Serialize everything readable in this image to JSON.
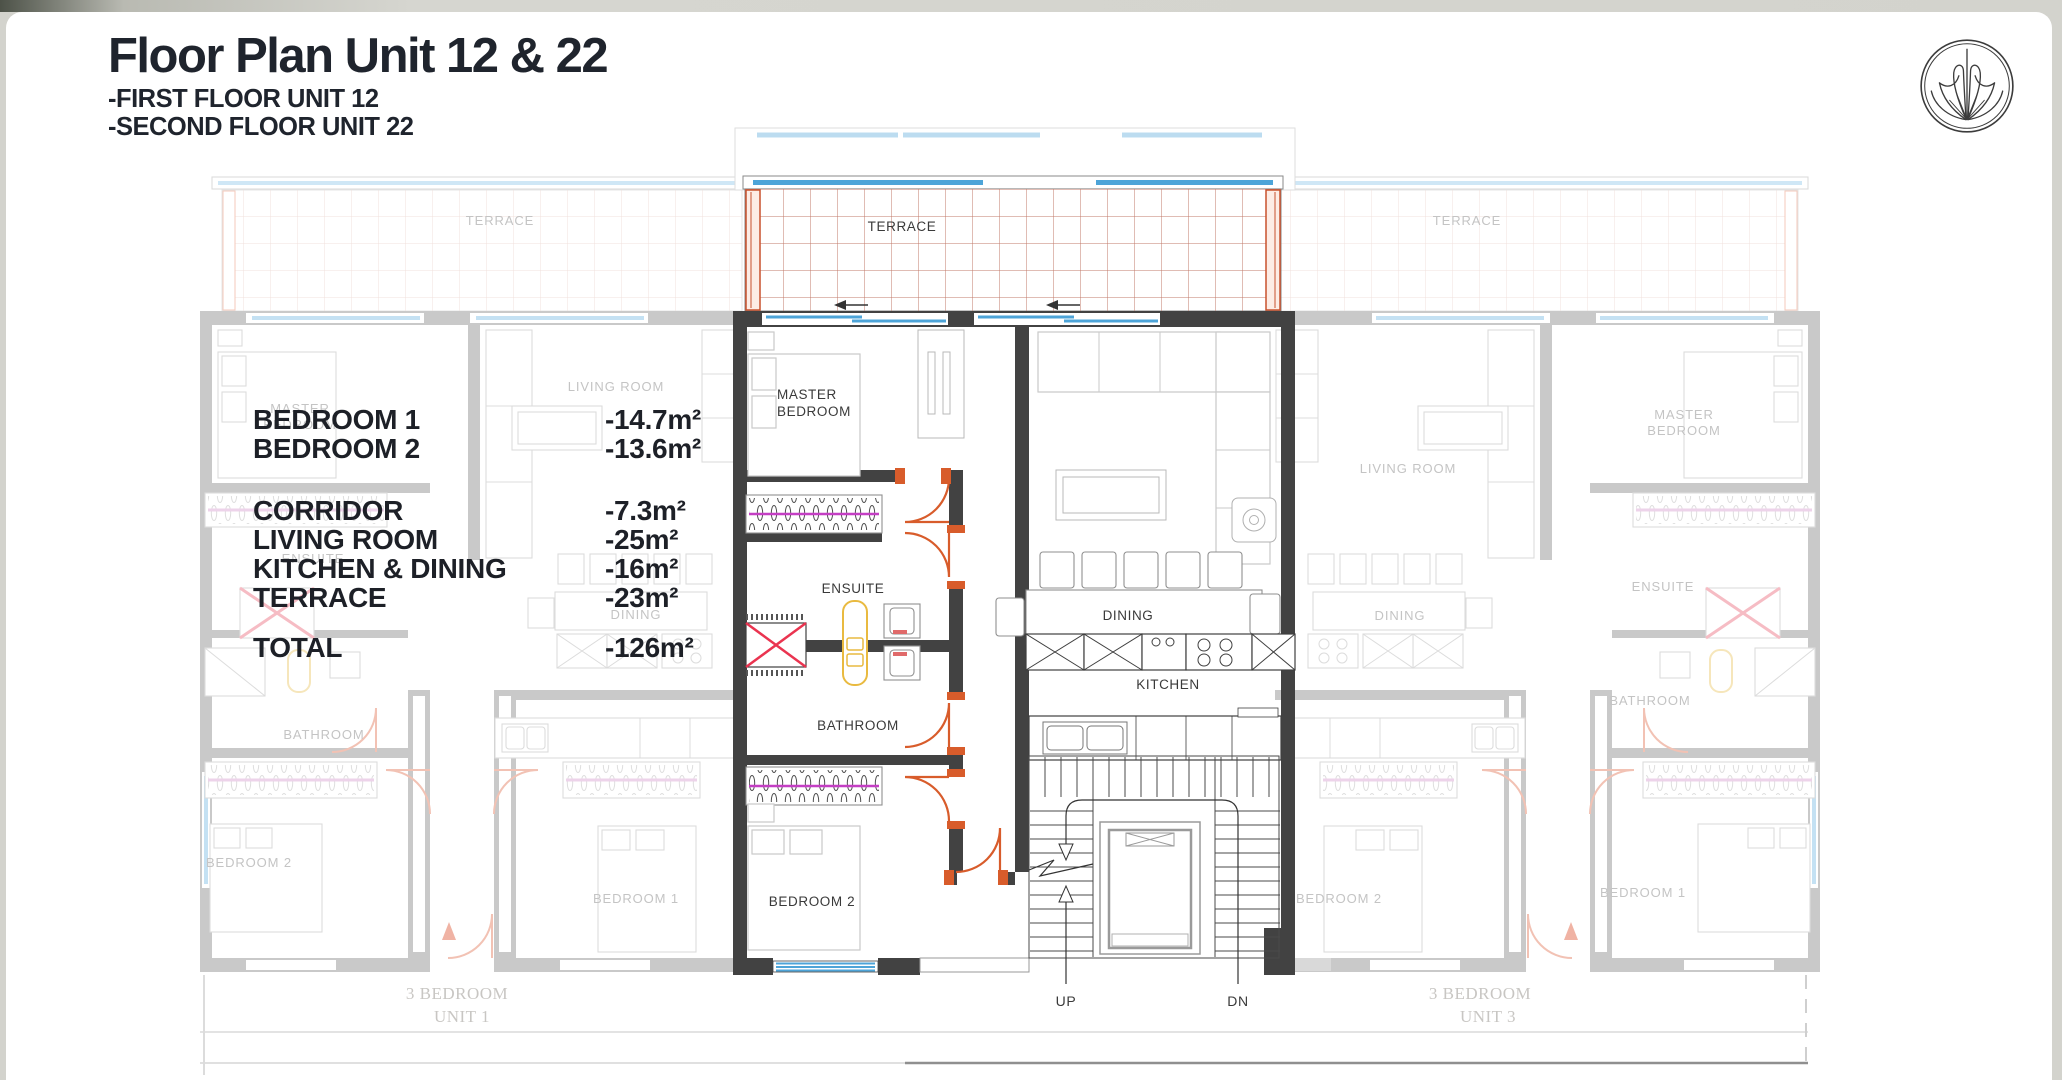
{
  "header": {
    "title": "Floor Plan Unit 12 & 22",
    "subtitle1": "-FIRST FLOOR UNIT 12",
    "subtitle2": "-SECOND FLOOR UNIT 22"
  },
  "logo": {
    "icon": "palm-shell-emblem"
  },
  "areas": {
    "rows": [
      {
        "label": "BEDROOM 1",
        "value": "-14.7m²"
      },
      {
        "label": "BEDROOM 2",
        "value": "-13.6m²"
      },
      {
        "label": "CORRIDOR",
        "value": "-7.3m²"
      },
      {
        "label": "LIVING ROOM",
        "value": "-25m²"
      },
      {
        "label": "KITCHEN & DINING",
        "value": "-16m²"
      },
      {
        "label": "TERRACE",
        "value": "-23m²"
      },
      {
        "label": "TOTAL",
        "value": "-126m²"
      }
    ]
  },
  "plan": {
    "center": {
      "terrace": "TERRACE",
      "master_line1": "MASTER",
      "master_line2": "BEDROOM",
      "ensuite": "ENSUITE",
      "bathroom": "BATHROOM",
      "bedroom2": "BEDROOM 2",
      "dining": "DINING",
      "kitchen": "KITCHEN",
      "up": "UP",
      "dn": "DN"
    },
    "left": {
      "terrace": "TERRACE",
      "living": "LIVING ROOM",
      "master_line1": "MASTER",
      "master_line2": "BEDROOM",
      "ensuite": "ENSUITE",
      "dining": "DINING",
      "bathroom": "BATHROOM",
      "bedroom2": "BEDROOM 2",
      "bedroom1": "BEDROOM 1",
      "caption1": "3 BEDROOM",
      "caption2": "UNIT 1"
    },
    "right": {
      "terrace": "TERRACE",
      "living": "LIVING ROOM",
      "master_line1": "MASTER",
      "master_line2": "BEDROOM",
      "ensuite": "ENSUITE",
      "dining": "DINING",
      "bathroom": "BATHROOM",
      "bedroom2": "BEDROOM 2",
      "bedroom1": "BEDROOM 1",
      "caption1": "3 BEDROOM",
      "caption2": "UNIT 3"
    }
  },
  "colors": {
    "wall_dark": "#424242",
    "door_orange": "#d85c2b",
    "window_blue": "#4da4d8",
    "terrace_grid": "#c07a68",
    "closet_rail_magenta": "#c43fc4",
    "fixture_yellow": "#e9ba40",
    "shaft_red": "#ea3450",
    "faded_line": "#c9c9c9",
    "title_ink": "#1f242d"
  }
}
